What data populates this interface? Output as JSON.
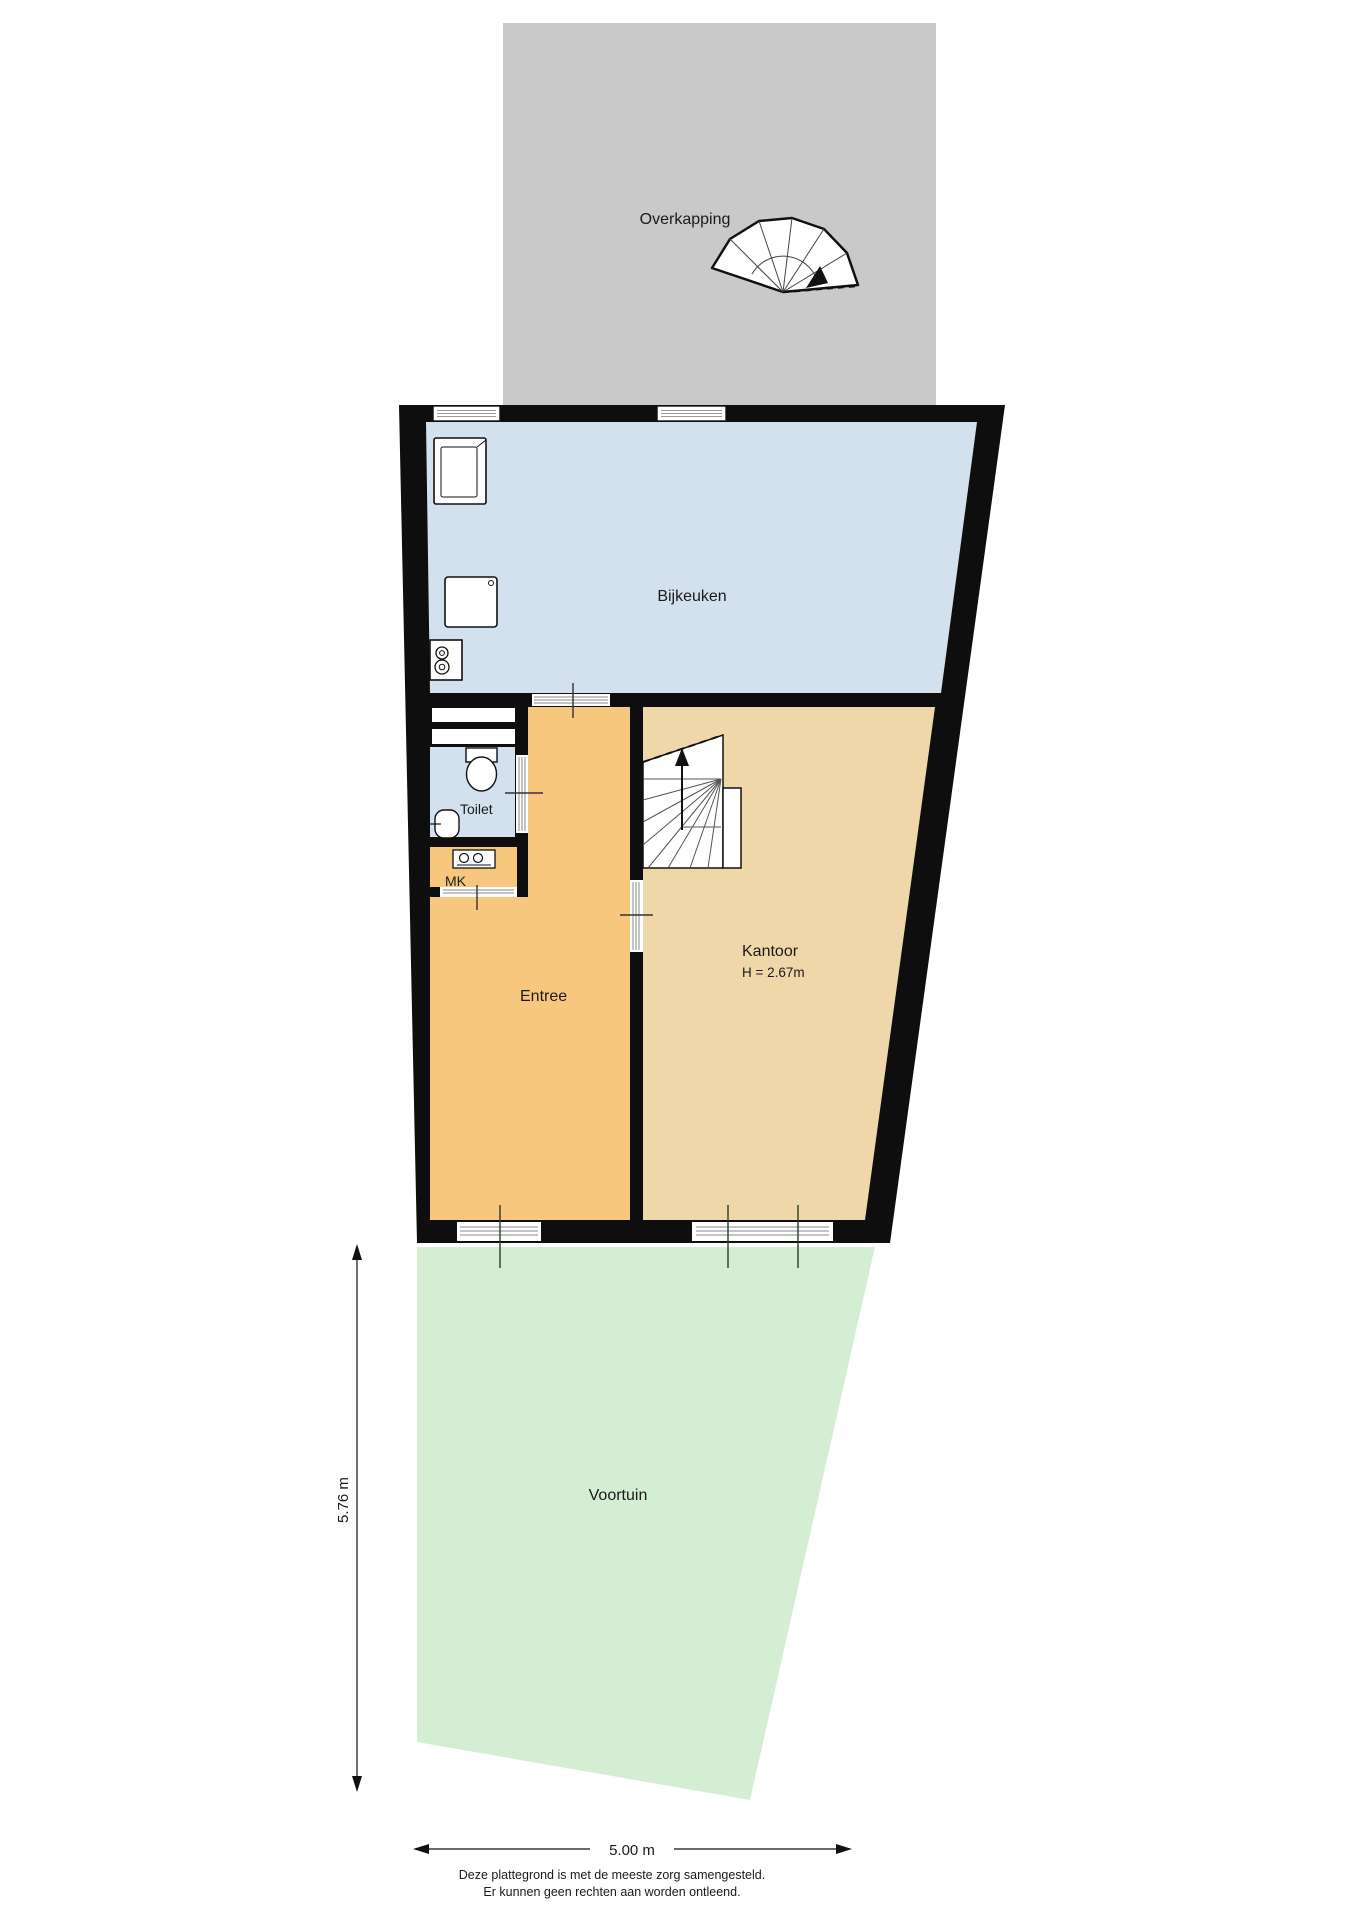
{
  "plan": {
    "rooms": {
      "overkapping": {
        "label": "Overkapping"
      },
      "bijkeuken": {
        "label": "Bijkeuken"
      },
      "toilet": {
        "label": "Toilet"
      },
      "mk": {
        "label": "MK"
      },
      "entree": {
        "label": "Entree"
      },
      "kantoor": {
        "label": "Kantoor",
        "height_note": "H = 2.67m"
      },
      "voortuin": {
        "label": "Voortuin"
      }
    },
    "dimensions": {
      "depth": "5.76 m",
      "width": "5.00 m"
    },
    "disclaimer": {
      "line1": "Deze plattegrond is met de meeste zorg samengesteld.",
      "line2": "Er kunnen geen rechten aan worden ontleend."
    },
    "colors": {
      "canopy": "#c9c9c9",
      "wall": "#0e0e0e",
      "utility_room": "#d3e0ee",
      "toilet_room": "#d3e0ee",
      "hall": "#f7c77e",
      "meter_cupboard": "#f7c77e",
      "office": "#efd7a9",
      "garden": "#d3eed3"
    }
  }
}
